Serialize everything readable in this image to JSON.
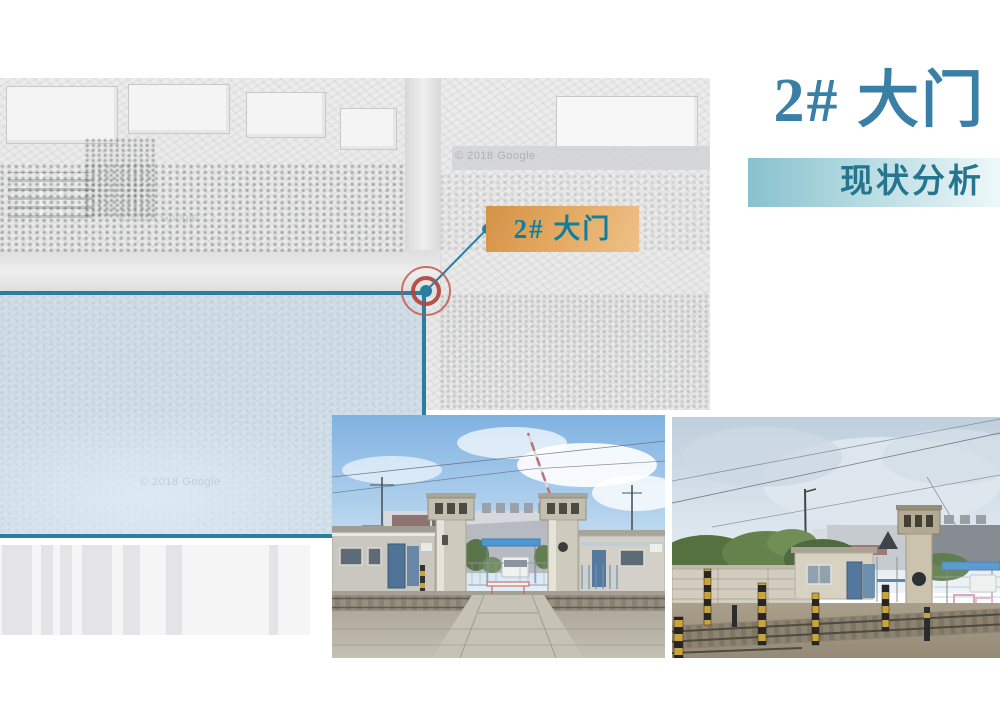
{
  "header": {
    "title": "2# 大门",
    "subtitle": "现状分析"
  },
  "map": {
    "watermark": "© 2018 Google",
    "gate_label": "2# 大门"
  },
  "photos": [
    {
      "name": "gate-front-view",
      "description": "Front view of gate 2#: twin concrete gate pillars, gate houses, blue canopy, truck, railway crossing in foreground"
    },
    {
      "name": "gate-side-view",
      "description": "Side view of gate 2#: boundary wall, gate house with blue door, gate pillar, railway tracks and striped posts"
    }
  ],
  "colors": {
    "accent_teal": "#3a7fa5",
    "subtitle_text": "#26758e",
    "bar_from": "#87c2ce",
    "bar_to": "#eef8f9",
    "overlay_border": "#2b7ea0",
    "overlay_fill": "rgba(185,211,230,0.45)",
    "marker_red": "#b2433c",
    "label_from": "#d39347",
    "label_to": "#eec189",
    "label_text": "#0f7f9e"
  },
  "decor": {
    "barcode_stripes": [
      {
        "x": 2,
        "w": 30
      },
      {
        "x": 41,
        "w": 12
      },
      {
        "x": 60,
        "w": 12
      },
      {
        "x": 82,
        "w": 30
      },
      {
        "x": 123,
        "w": 17
      },
      {
        "x": 166,
        "w": 16
      },
      {
        "x": 269,
        "w": 9
      }
    ]
  }
}
